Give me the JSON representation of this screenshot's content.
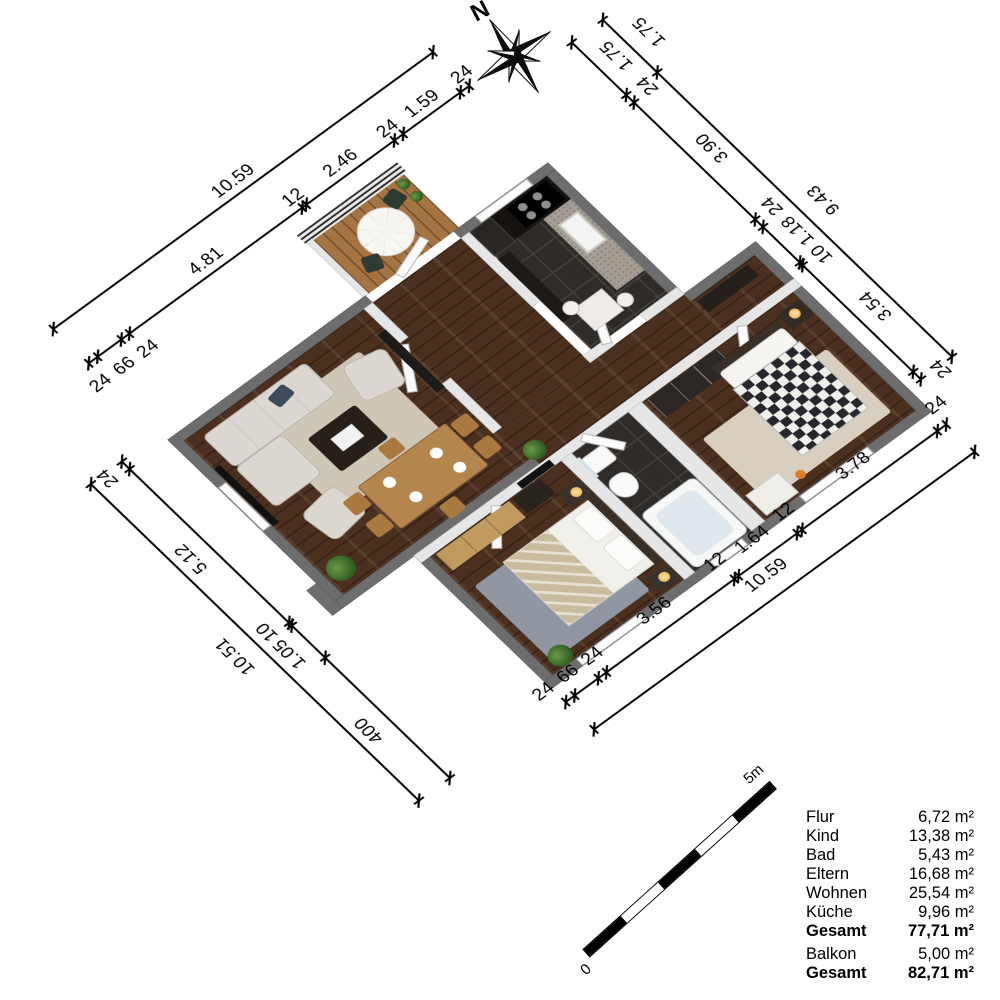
{
  "compass": {
    "north_label": "N"
  },
  "scale_bar": {
    "start_label": "0",
    "end_label": "5m",
    "segments": 5
  },
  "legend": {
    "rows": [
      {
        "label": "Flur",
        "value": "6,72 m²",
        "bold": false,
        "gap": false
      },
      {
        "label": "Kind",
        "value": "13,38 m²",
        "bold": false,
        "gap": false
      },
      {
        "label": "Bad",
        "value": "5,43 m²",
        "bold": false,
        "gap": false
      },
      {
        "label": "Eltern",
        "value": "16,68 m²",
        "bold": false,
        "gap": false
      },
      {
        "label": "Wohnen",
        "value": "25,54 m²",
        "bold": false,
        "gap": false
      },
      {
        "label": "Küche",
        "value": "9,96 m²",
        "bold": false,
        "gap": false
      },
      {
        "label": "Gesamt",
        "value": "77,71 m²",
        "bold": true,
        "gap": false
      },
      {
        "label": "Balkon",
        "value": "5,00 m²",
        "bold": false,
        "gap": true
      },
      {
        "label": "Gesamt",
        "value": "82,71 m²",
        "bold": true,
        "gap": false
      }
    ]
  },
  "dimensions": {
    "top_outer": {
      "labels": [
        "10.59"
      ]
    },
    "top_inner": {
      "labels": [
        "24",
        "66",
        "24",
        "4.81",
        "12",
        "2.46",
        "24",
        "1.59",
        "24"
      ]
    },
    "right_outer": {
      "labels": [
        "1.75",
        "9.43"
      ]
    },
    "right_inner": {
      "labels": [
        "1.75",
        "24",
        "3.90",
        "24",
        "1.18",
        "10",
        "3.54",
        "24"
      ]
    },
    "left_outer": {
      "labels": [
        "10.51"
      ]
    },
    "left_inner": {
      "labels": [
        "24",
        "5.12",
        "10",
        "1.05",
        "400"
      ]
    },
    "bottom_outer": {
      "labels": [
        "10.59"
      ]
    },
    "bottom_inner": {
      "labels": [
        "24",
        "66",
        "24",
        "3.56",
        "12",
        "1.64",
        "12",
        "3.78",
        "24"
      ]
    }
  },
  "palette": {
    "wall_exterior": "#6d6d6d",
    "wall_interior": "#e6e6e6",
    "floor_wood": "#513321",
    "floor_tile": "#2e2b28",
    "balcony_deck": "#a57442",
    "dimension_ink": "#000000",
    "background": "#ffffff"
  }
}
